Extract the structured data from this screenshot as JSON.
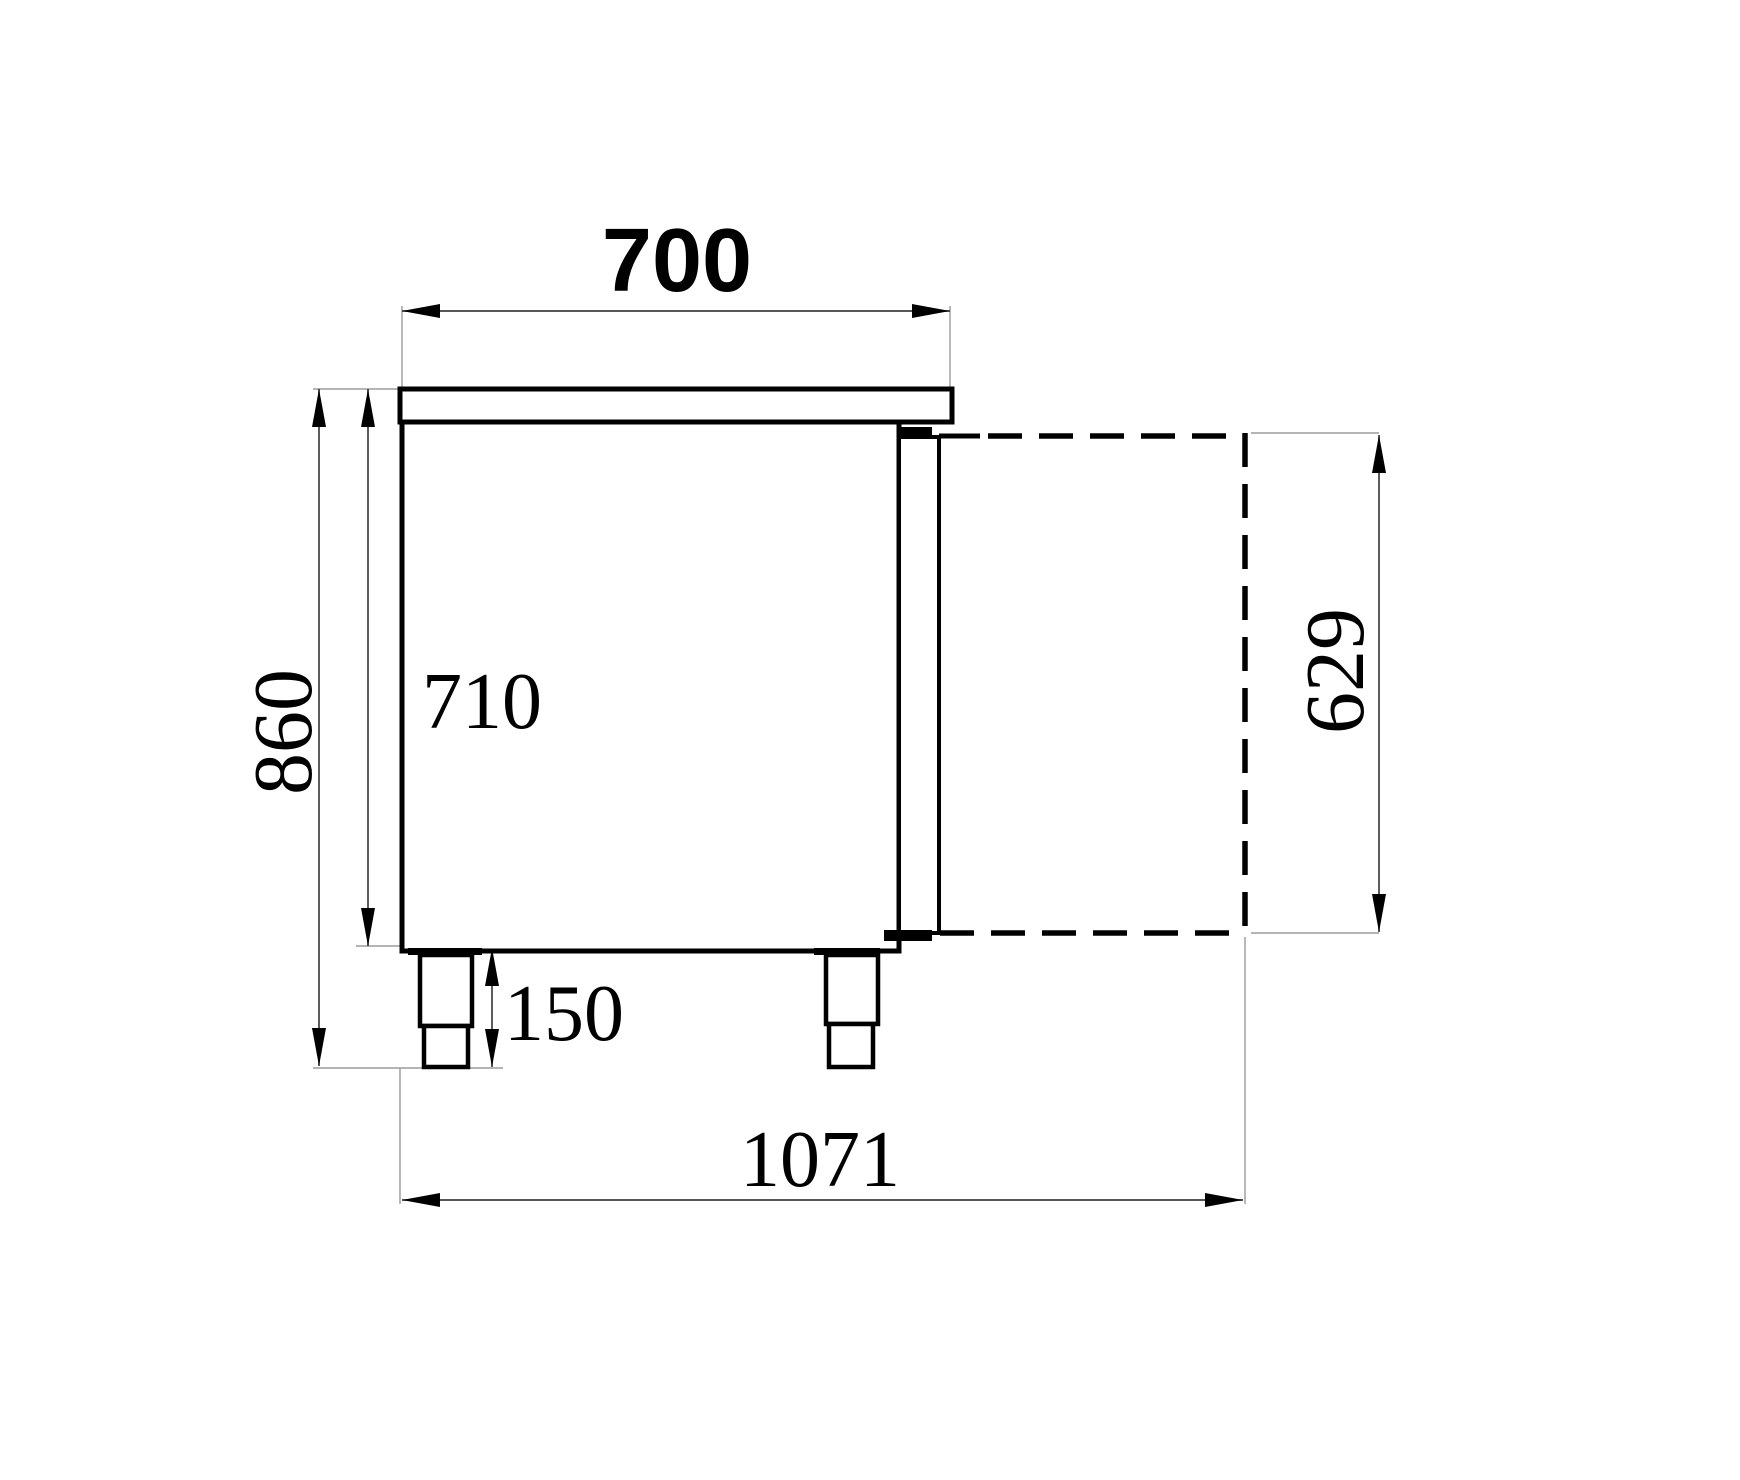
{
  "drawing": {
    "background": "#ffffff",
    "colors": {
      "outline": "#000000",
      "dim_line": "#3f3f3f",
      "extension_line": "#9b9b9b",
      "text": "#000000"
    },
    "dimensions": {
      "top_width": "700",
      "body_height": "710",
      "total_height": "860",
      "leg_height": "150",
      "total_depth_open": "1071",
      "door_height": "629"
    }
  }
}
